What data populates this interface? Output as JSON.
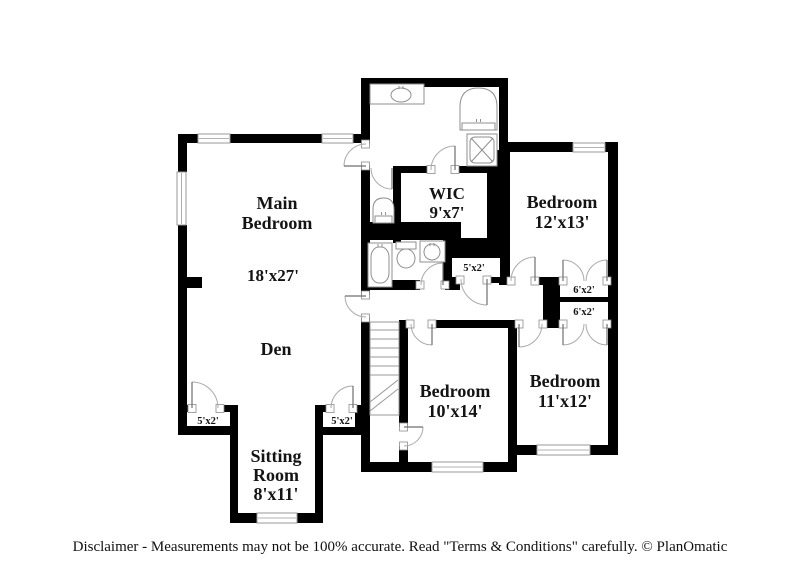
{
  "disclaimer": {
    "text": "Disclaimer - Measurements may not be 100% accurate. Read \"Terms & Conditions\" carefully. © PlanOmatic"
  },
  "colors": {
    "wall": "#000000",
    "window_fill": "#ffffff",
    "window_stroke": "#9a9a9a",
    "door_arc": "#ababab",
    "door_leaf": "#6f6f6f",
    "jamb_stroke": "#8d8d8d",
    "fixture_stroke": "#8f8f8f",
    "stairs_stroke": "#9a9a9a",
    "text": "#141414"
  },
  "plan": {
    "walls": [
      {
        "x": 361,
        "y": 78,
        "w": 147,
        "h": 9
      },
      {
        "x": 361,
        "y": 87,
        "w": 9,
        "h": 57
      },
      {
        "x": 361,
        "y": 166,
        "w": 9,
        "h": 129
      },
      {
        "x": 361,
        "y": 318,
        "w": 9,
        "h": 154
      },
      {
        "x": 499,
        "y": 78,
        "w": 9,
        "h": 72
      },
      {
        "x": 178,
        "y": 134,
        "w": 20,
        "h": 9
      },
      {
        "x": 230,
        "y": 134,
        "w": 92,
        "h": 9
      },
      {
        "x": 353,
        "y": 134,
        "w": 17,
        "h": 9
      },
      {
        "x": 178,
        "y": 134,
        "w": 9,
        "h": 38
      },
      {
        "x": 178,
        "y": 225,
        "w": 9,
        "h": 210
      },
      {
        "x": 187,
        "y": 277,
        "w": 15,
        "h": 11
      },
      {
        "x": 178,
        "y": 405,
        "w": 14,
        "h": 7
      },
      {
        "x": 220,
        "y": 405,
        "w": 12,
        "h": 7
      },
      {
        "x": 178,
        "y": 426,
        "w": 60,
        "h": 9
      },
      {
        "x": 230,
        "y": 405,
        "w": 8,
        "h": 118
      },
      {
        "x": 230,
        "y": 513,
        "w": 27,
        "h": 10
      },
      {
        "x": 297,
        "y": 513,
        "w": 26,
        "h": 10
      },
      {
        "x": 315,
        "y": 405,
        "w": 8,
        "h": 118
      },
      {
        "x": 315,
        "y": 405,
        "w": 15,
        "h": 7
      },
      {
        "x": 353,
        "y": 405,
        "w": 10,
        "h": 7
      },
      {
        "x": 315,
        "y": 427,
        "w": 48,
        "h": 8
      },
      {
        "x": 355,
        "y": 405,
        "w": 8,
        "h": 30
      },
      {
        "x": 355,
        "y": 410,
        "w": 15,
        "h": 8
      },
      {
        "x": 393,
        "y": 166,
        "w": 38,
        "h": 7
      },
      {
        "x": 455,
        "y": 166,
        "w": 43,
        "h": 7
      },
      {
        "x": 393,
        "y": 166,
        "w": 8,
        "h": 77
      },
      {
        "x": 487,
        "y": 150,
        "w": 23,
        "h": 92
      },
      {
        "x": 361,
        "y": 222,
        "w": 100,
        "h": 18
      },
      {
        "x": 443,
        "y": 238,
        "w": 67,
        "h": 20
      },
      {
        "x": 443,
        "y": 258,
        "w": 9,
        "h": 25
      },
      {
        "x": 500,
        "y": 256,
        "w": 10,
        "h": 29
      },
      {
        "x": 361,
        "y": 280,
        "w": 59,
        "h": 10
      },
      {
        "x": 445,
        "y": 280,
        "w": 15,
        "h": 10
      },
      {
        "x": 443,
        "y": 277,
        "w": 17,
        "h": 6
      },
      {
        "x": 487,
        "y": 277,
        "w": 13,
        "h": 6
      },
      {
        "x": 499,
        "y": 277,
        "w": 12,
        "h": 8
      },
      {
        "x": 535,
        "y": 277,
        "w": 28,
        "h": 8
      },
      {
        "x": 607,
        "y": 277,
        "w": 11,
        "h": 8
      },
      {
        "x": 505,
        "y": 142,
        "w": 68,
        "h": 10
      },
      {
        "x": 605,
        "y": 142,
        "w": 13,
        "h": 10
      },
      {
        "x": 608,
        "y": 142,
        "w": 10,
        "h": 313
      },
      {
        "x": 543,
        "y": 277,
        "w": 17,
        "h": 48
      },
      {
        "x": 560,
        "y": 297,
        "w": 48,
        "h": 5
      },
      {
        "x": 399,
        "y": 320,
        "w": 11,
        "h": 8
      },
      {
        "x": 432,
        "y": 320,
        "w": 87,
        "h": 8
      },
      {
        "x": 543,
        "y": 320,
        "w": 20,
        "h": 8
      },
      {
        "x": 607,
        "y": 320,
        "w": 11,
        "h": 8
      },
      {
        "x": 508,
        "y": 320,
        "w": 9,
        "h": 152
      },
      {
        "x": 361,
        "y": 462,
        "w": 71,
        "h": 10
      },
      {
        "x": 483,
        "y": 462,
        "w": 34,
        "h": 10
      },
      {
        "x": 508,
        "y": 445,
        "w": 29,
        "h": 10
      },
      {
        "x": 590,
        "y": 445,
        "w": 28,
        "h": 10
      },
      {
        "x": 399,
        "y": 328,
        "w": 9,
        "h": 99
      },
      {
        "x": 399,
        "y": 446,
        "w": 9,
        "h": 26
      }
    ],
    "windows": [
      {
        "x": 198,
        "y": 134,
        "w": 32,
        "h": 9
      },
      {
        "x": 322,
        "y": 134,
        "w": 31,
        "h": 9
      },
      {
        "x": 177,
        "y": 172,
        "w": 9,
        "h": 53
      },
      {
        "x": 573,
        "y": 143,
        "w": 32,
        "h": 9
      },
      {
        "x": 537,
        "y": 445,
        "w": 53,
        "h": 10
      },
      {
        "x": 432,
        "y": 462,
        "w": 51,
        "h": 10
      },
      {
        "x": 257,
        "y": 513,
        "w": 40,
        "h": 10
      }
    ],
    "doors": [
      {
        "name": "door-main-bedroom",
        "hinge": [
          366,
          166
        ],
        "r": 22,
        "a1": 90,
        "a2": 180,
        "opening": {
          "x": 361,
          "y": 144,
          "w": 9,
          "h": 22
        }
      },
      {
        "name": "door-vestibule",
        "hinge": [
          392,
          168
        ],
        "r": 21,
        "a1": 180,
        "a2": 270
      },
      {
        "name": "door-wic",
        "hinge": [
          455,
          170
        ],
        "r": 24,
        "a1": 180,
        "a2": 90,
        "opening": {
          "x": 431,
          "y": 166,
          "w": 24,
          "h": 7
        }
      },
      {
        "name": "door-bathroom2",
        "hinge": [
          443,
          285
        ],
        "r": 22,
        "a1": 180,
        "a2": 90,
        "opening": {
          "x": 420,
          "y": 280,
          "w": 25,
          "h": 10
        }
      },
      {
        "name": "door-hall-closet",
        "hinge": [
          487,
          279
        ],
        "r": 26,
        "a1": 180,
        "a2": 270,
        "opening": {
          "x": 460,
          "y": 277,
          "w": 27,
          "h": 6
        }
      },
      {
        "name": "door-den-hall",
        "hinge": [
          366,
          296
        ],
        "r": 21,
        "a1": 270,
        "a2": 180,
        "opening": {
          "x": 361,
          "y": 295,
          "w": 9,
          "h": 23
        }
      },
      {
        "name": "door-bedroom-12x13",
        "hinge": [
          535,
          281
        ],
        "r": 24,
        "a1": 180,
        "a2": 90,
        "opening": {
          "x": 511,
          "y": 277,
          "w": 24,
          "h": 8
        }
      },
      {
        "name": "closet-door-6x2-a-left",
        "hinge": [
          563,
          281
        ],
        "r": 21,
        "a1": 0,
        "a2": 90,
        "opening": {
          "x": 563,
          "y": 277,
          "w": 44,
          "h": 8
        }
      },
      {
        "name": "closet-door-6x2-a-right",
        "hinge": [
          607,
          281
        ],
        "r": 21,
        "a1": 180,
        "a2": 90
      },
      {
        "name": "closet-door-6x2-b-left",
        "hinge": [
          563,
          324
        ],
        "r": 21,
        "a1": 0,
        "a2": 270,
        "opening": {
          "x": 563,
          "y": 320,
          "w": 44,
          "h": 8
        }
      },
      {
        "name": "closet-door-6x2-b-right",
        "hinge": [
          607,
          324
        ],
        "r": 21,
        "a1": 180,
        "a2": 270
      },
      {
        "name": "door-bedroom-11x12",
        "hinge": [
          519,
          324
        ],
        "r": 23,
        "a1": 0,
        "a2": 270,
        "opening": {
          "x": 519,
          "y": 320,
          "w": 24,
          "h": 8
        }
      },
      {
        "name": "door-bedroom-10x14",
        "hinge": [
          432,
          324
        ],
        "r": 21,
        "a1": 180,
        "a2": 270,
        "opening": {
          "x": 410,
          "y": 320,
          "w": 22,
          "h": 8
        }
      },
      {
        "name": "door-bedroom-10x14-side",
        "hinge": [
          404,
          427
        ],
        "r": 19,
        "a1": 270,
        "a2": 0,
        "opening": {
          "x": 399,
          "y": 427,
          "w": 9,
          "h": 19
        }
      },
      {
        "name": "closet-door-5x2-left",
        "hinge": [
          192,
          408
        ],
        "r": 26,
        "a1": 0,
        "a2": 90,
        "opening": {
          "x": 192,
          "y": 405,
          "w": 28,
          "h": 7
        }
      },
      {
        "name": "closet-door-5x2-right",
        "hinge": [
          353,
          408
        ],
        "r": 22,
        "a1": 180,
        "a2": 90,
        "opening": {
          "x": 330,
          "y": 405,
          "w": 23,
          "h": 7
        }
      }
    ],
    "stairs": {
      "x": 370,
      "y": 322,
      "w": 29,
      "h": 93,
      "treads": [
        330,
        339,
        348,
        357,
        366,
        375
      ],
      "breaks": [
        [
          370,
          402,
          398,
          380
        ],
        [
          370,
          411,
          398,
          389
        ]
      ]
    },
    "fixtures": [
      {
        "type": "counter-sink",
        "name": "bathroom1-vanity-sink",
        "x": 370,
        "y": 84,
        "w": 54,
        "h": 20,
        "cx": 401,
        "cy": 95,
        "rx": 10,
        "ry": 7
      },
      {
        "type": "toilet-up",
        "name": "bathroom1-toilet",
        "x": 460,
        "y": 88,
        "w": 37,
        "h": 42
      },
      {
        "type": "shower",
        "name": "bathroom1-shower",
        "x": 467,
        "y": 134,
        "w": 30,
        "h": 32
      },
      {
        "type": "toilet-up",
        "name": "vestibule-toilet",
        "x": 373,
        "y": 198,
        "w": 21,
        "h": 25
      },
      {
        "type": "tub",
        "name": "bathroom2-bathtub",
        "x": 368,
        "y": 243,
        "w": 24,
        "h": 44
      },
      {
        "type": "toilet-down",
        "name": "bathroom2-toilet",
        "x": 396,
        "y": 242,
        "w": 20,
        "h": 26
      },
      {
        "type": "counter-sink",
        "name": "bathroom2-sink",
        "x": 420,
        "y": 241,
        "w": 25,
        "h": 21,
        "cx": 432,
        "cy": 252,
        "rx": 8,
        "ry": 8
      }
    ],
    "labels": [
      {
        "name": "label-main-bedroom",
        "x": 277,
        "y": 209,
        "lh": 20,
        "size": 18,
        "lines": [
          "Main",
          "Bedroom"
        ]
      },
      {
        "name": "label-main-bedroom-dims",
        "x": 273,
        "y": 281,
        "lh": 20,
        "size": 17,
        "lines": [
          "18'x27'"
        ]
      },
      {
        "name": "label-den",
        "x": 276,
        "y": 355,
        "lh": 20,
        "size": 18,
        "lines": [
          "Den"
        ]
      },
      {
        "name": "label-wic",
        "x": 447,
        "y": 199,
        "lh": 19,
        "size": 17,
        "lines": [
          "WIC",
          "9'x7'"
        ]
      },
      {
        "name": "label-bedroom-12x13",
        "x": 562,
        "y": 208,
        "lh": 20,
        "size": 18,
        "lines": [
          "Bedroom",
          "12'x13'"
        ]
      },
      {
        "name": "label-bedroom-10x14",
        "x": 455,
        "y": 397,
        "lh": 20,
        "size": 18,
        "lines": [
          "Bedroom",
          "10'x14'"
        ]
      },
      {
        "name": "label-bedroom-11x12",
        "x": 565,
        "y": 387,
        "lh": 20,
        "size": 18,
        "lines": [
          "Bedroom",
          "11'x12'"
        ]
      },
      {
        "name": "label-sitting-room",
        "x": 276,
        "y": 462,
        "lh": 19,
        "size": 18,
        "lines": [
          "Sitting",
          "Room",
          "8'x11'"
        ]
      },
      {
        "name": "label-closet-5x2-hall",
        "x": 474,
        "y": 271,
        "lh": 12,
        "size": 10.5,
        "lines": [
          "5'x2'"
        ]
      },
      {
        "name": "label-closet-6x2-a",
        "x": 584,
        "y": 293,
        "lh": 12,
        "size": 10.5,
        "lines": [
          "6'x2'"
        ]
      },
      {
        "name": "label-closet-6x2-b",
        "x": 584,
        "y": 315,
        "lh": 12,
        "size": 10.5,
        "lines": [
          "6'x2'"
        ]
      },
      {
        "name": "label-closet-5x2-left",
        "x": 208,
        "y": 424,
        "lh": 12,
        "size": 10.5,
        "lines": [
          "5'x2'"
        ]
      },
      {
        "name": "label-closet-5x2-right",
        "x": 342,
        "y": 424,
        "lh": 12,
        "size": 10.5,
        "lines": [
          "5'x2'"
        ]
      }
    ]
  }
}
